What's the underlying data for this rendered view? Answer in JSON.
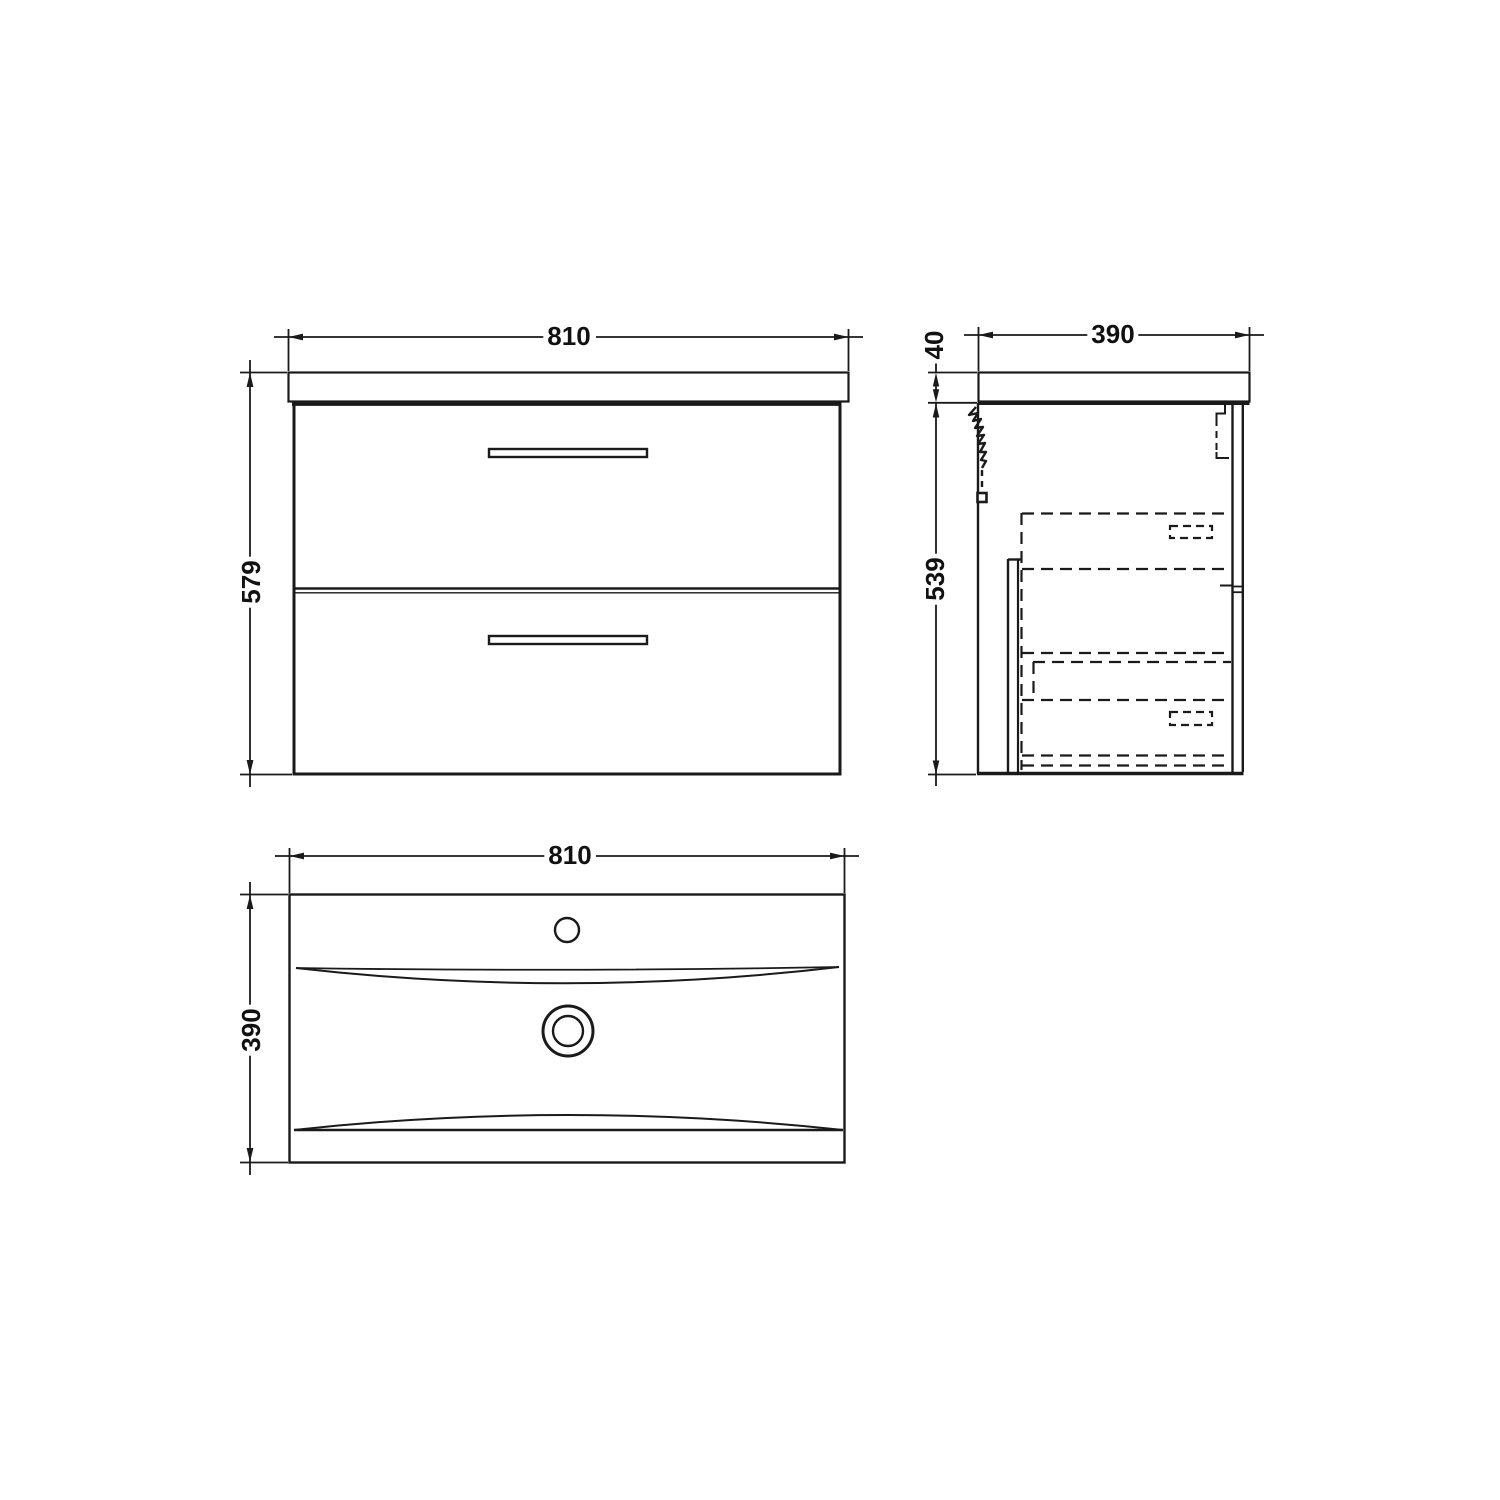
{
  "drawing": {
    "background": "#ffffff",
    "line_color": "#1a1a1a",
    "views": {
      "front": {
        "width_mm": "810",
        "height_mm": "579"
      },
      "side": {
        "depth_mm": "390",
        "worktop_thickness_mm": "40",
        "cabinet_height_mm": "539"
      },
      "plan": {
        "width_mm": "810",
        "depth_mm": "390"
      }
    }
  }
}
